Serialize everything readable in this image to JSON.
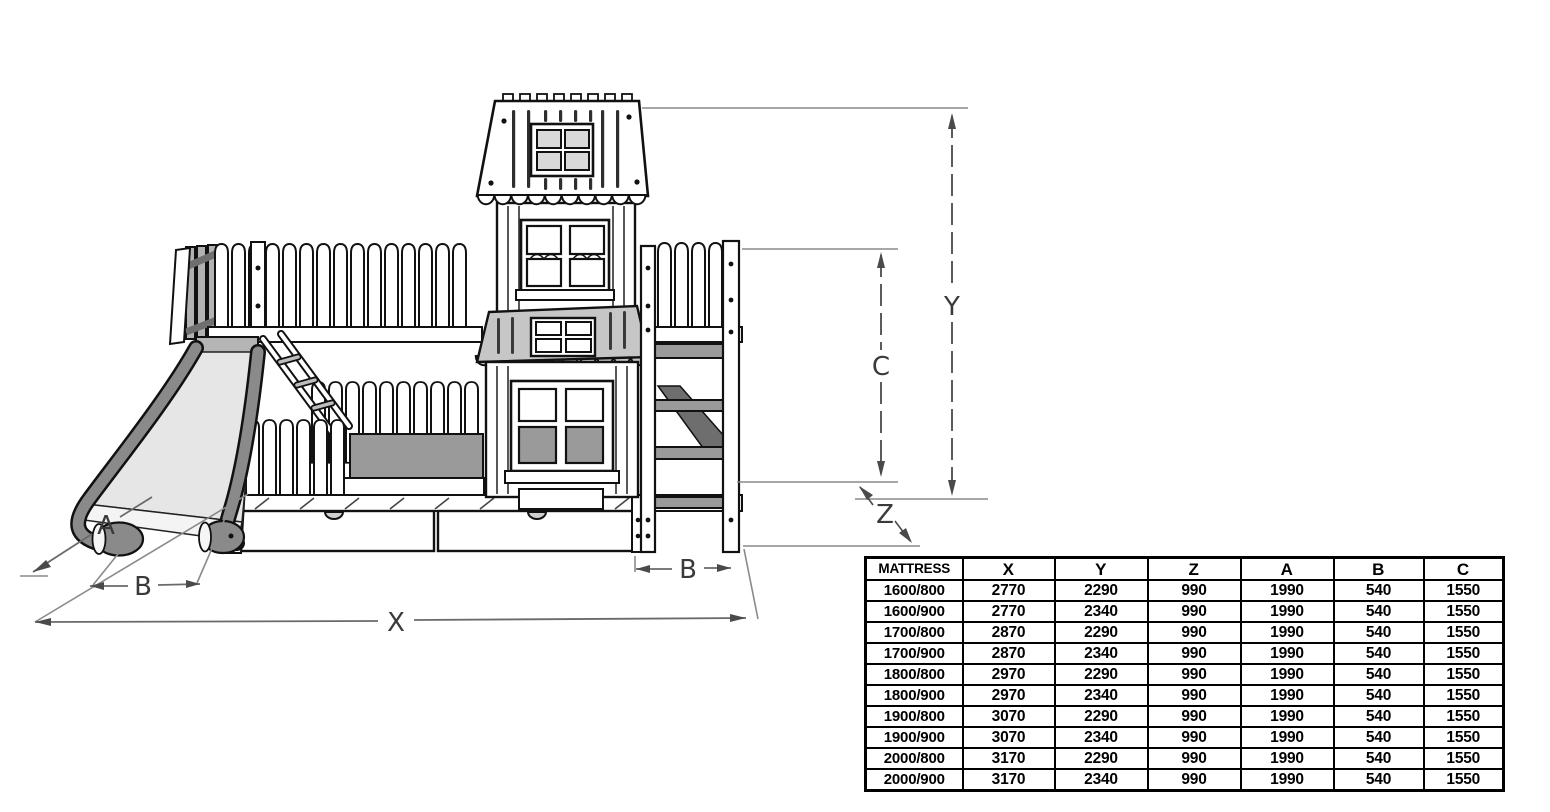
{
  "diagram": {
    "labels": {
      "x": "X",
      "y": "Y",
      "z": "Z",
      "a": "A",
      "b_left": "B",
      "b_right": "B",
      "c": "C"
    }
  },
  "table": {
    "headers": [
      "MATTRESS",
      "X",
      "Y",
      "Z",
      "A",
      "B",
      "C"
    ],
    "rows": [
      [
        "1600/800",
        "2770",
        "2290",
        "990",
        "1990",
        "540",
        "1550"
      ],
      [
        "1600/900",
        "2770",
        "2340",
        "990",
        "1990",
        "540",
        "1550"
      ],
      [
        "1700/800",
        "2870",
        "2290",
        "990",
        "1990",
        "540",
        "1550"
      ],
      [
        "1700/900",
        "2870",
        "2340",
        "990",
        "1990",
        "540",
        "1550"
      ],
      [
        "1800/800",
        "2970",
        "2290",
        "990",
        "1990",
        "540",
        "1550"
      ],
      [
        "1800/900",
        "2970",
        "2340",
        "990",
        "1990",
        "540",
        "1550"
      ],
      [
        "1900/800",
        "3070",
        "2290",
        "990",
        "1990",
        "540",
        "1550"
      ],
      [
        "1900/900",
        "3070",
        "2340",
        "990",
        "1990",
        "540",
        "1550"
      ],
      [
        "2000/800",
        "3170",
        "2290",
        "990",
        "1990",
        "540",
        "1550"
      ],
      [
        "2000/900",
        "3170",
        "2340",
        "990",
        "1990",
        "540",
        "1550"
      ]
    ]
  },
  "colors": {
    "line": "#111111",
    "dimension_line": "#6a6a6a",
    "extension_line": "#8a8a8a",
    "gray_panel": "#9a9a9a",
    "awning_roof": "#c6c6c6",
    "slide_rail": "#8a8a8a",
    "stair_wedge": "#6e6e6e",
    "background": "#ffffff"
  }
}
